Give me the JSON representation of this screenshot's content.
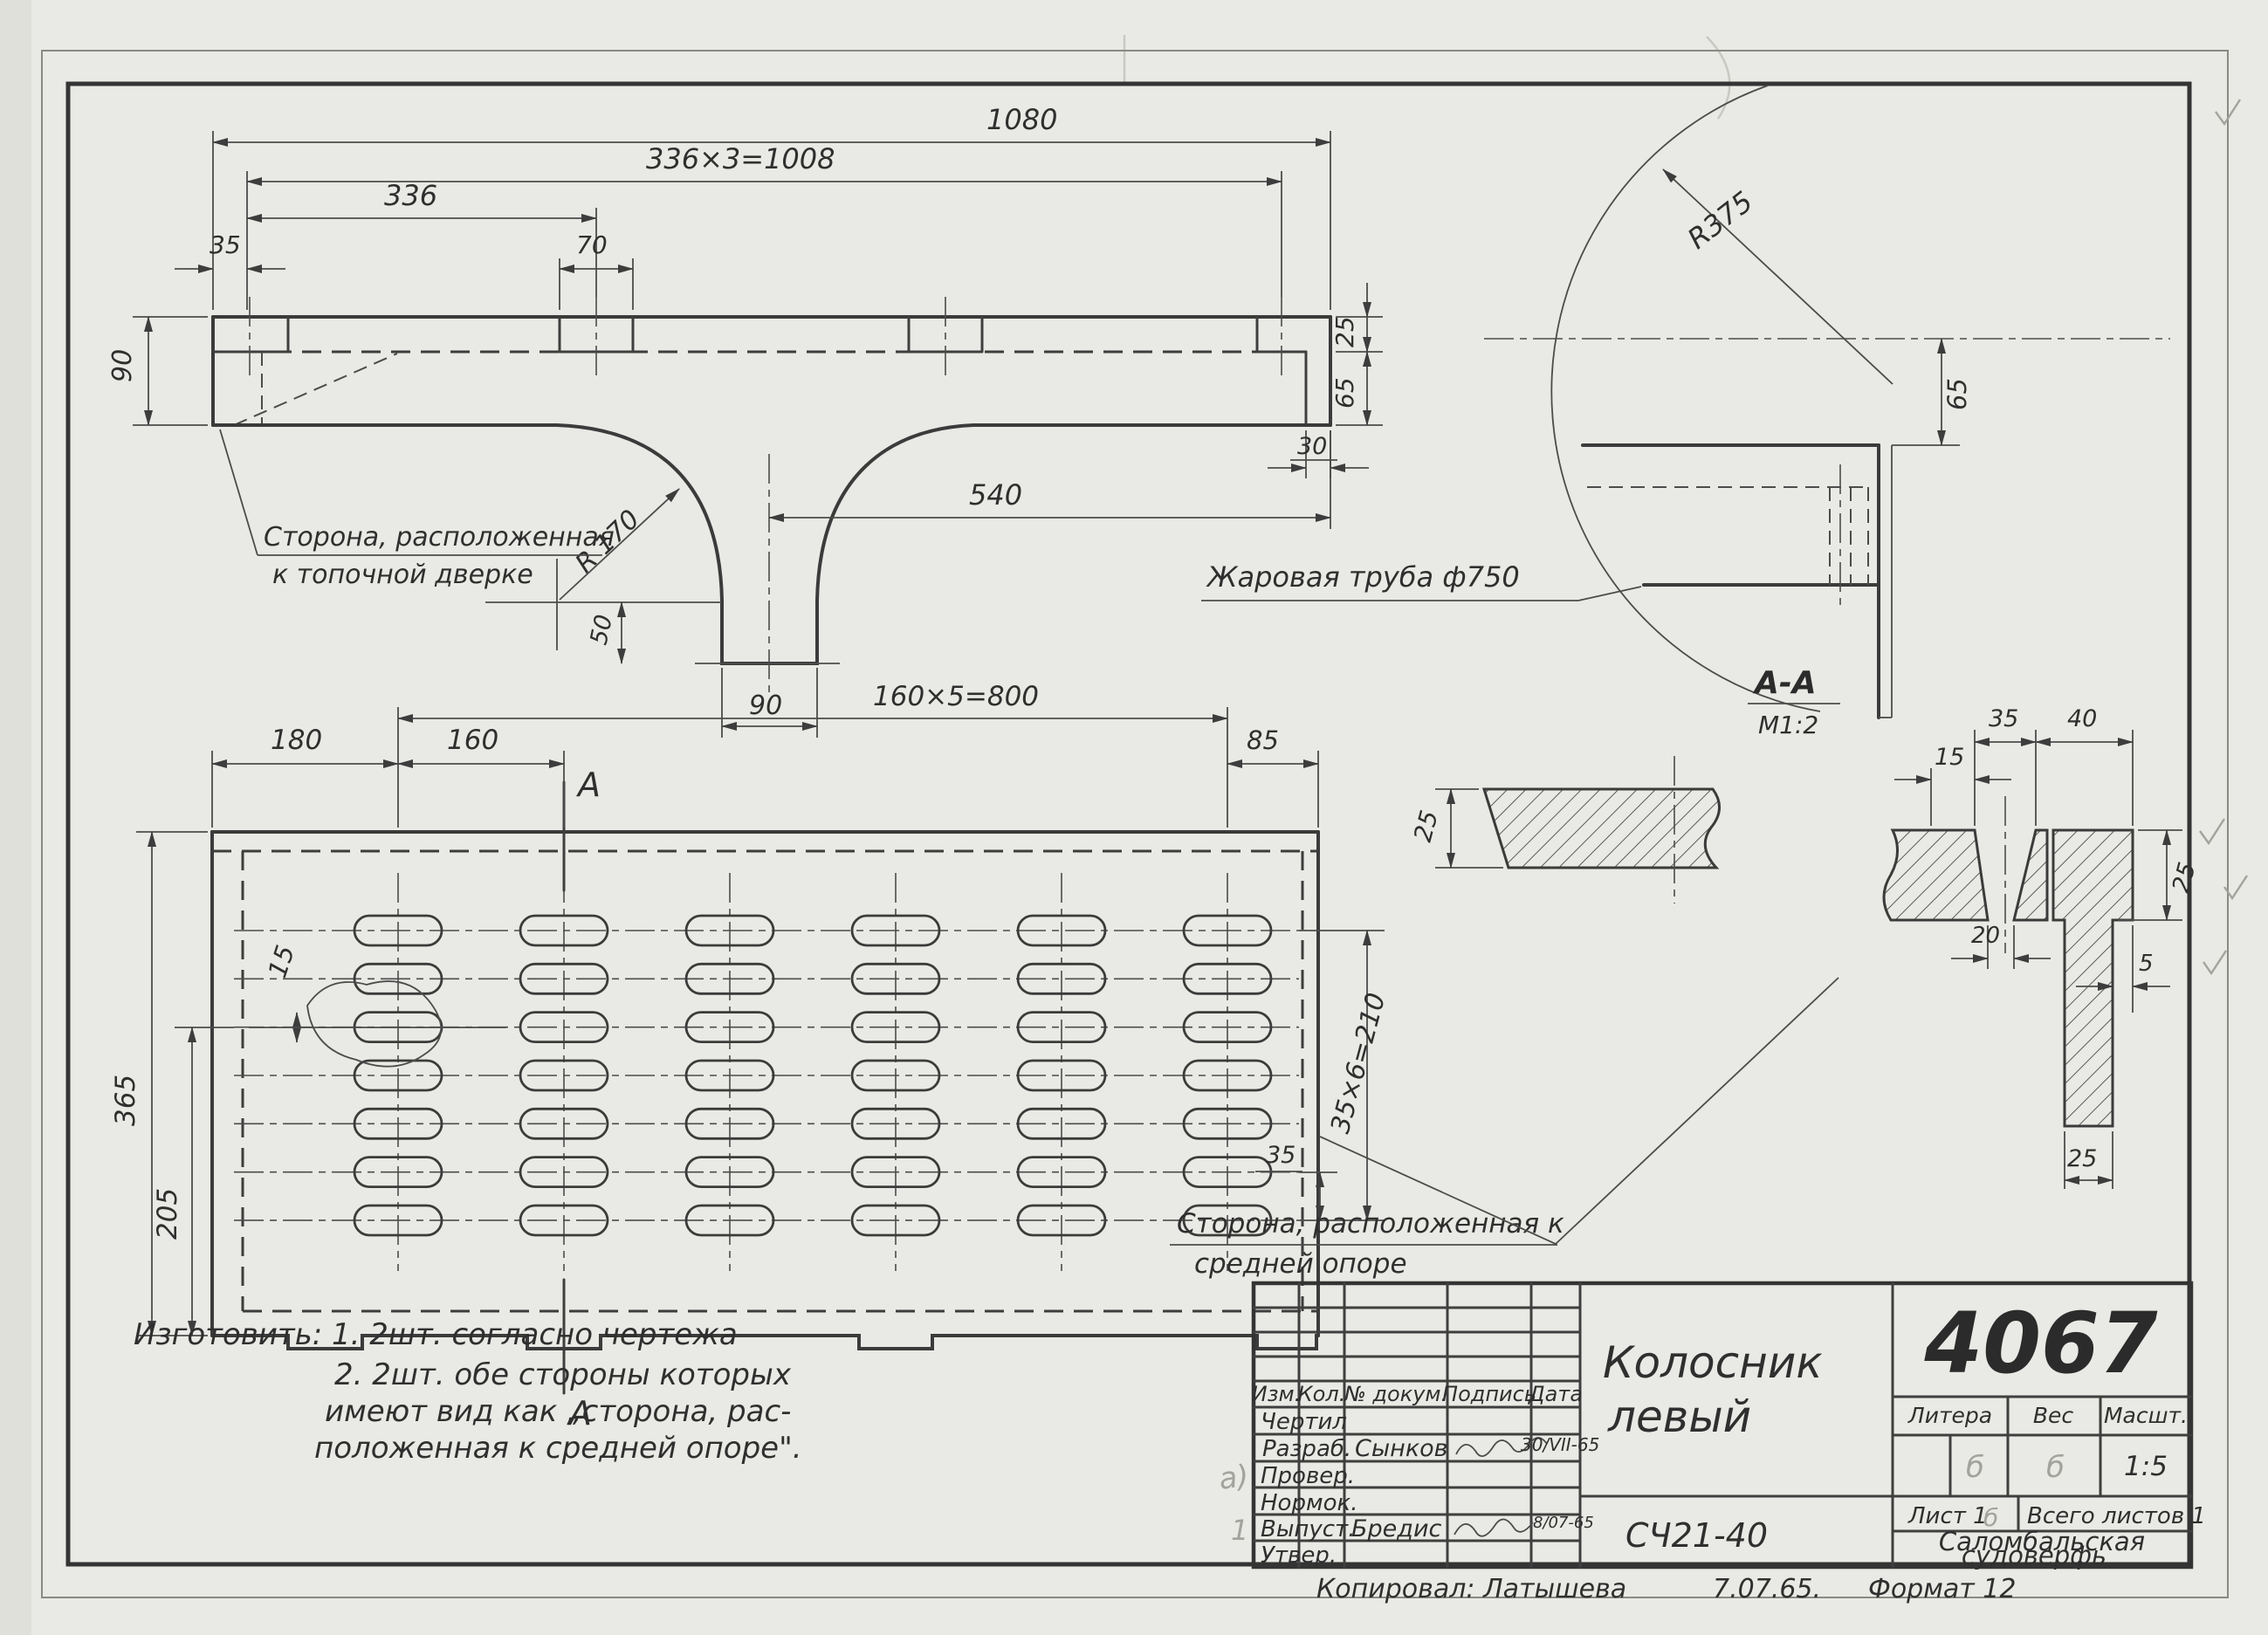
{
  "side_view": {
    "dim_1080": "1080",
    "dim_1008": "336×3=1008",
    "dim_336": "336",
    "dim_35": "35",
    "dim_70": "70",
    "dim_90_left": "90",
    "dim_25": "25",
    "dim_65": "65",
    "dim_30": "30",
    "dim_540": "540",
    "dim_50": "50",
    "dim_90_leg": "90",
    "radius_fillet": "R 170",
    "label_door_side_1": "Сторона, расположенная",
    "label_door_side_2": "к топочной дверке"
  },
  "detail_view": {
    "radius": "R375",
    "dim_65": "65",
    "flue_label": "Жаровая труба ф750"
  },
  "plan_view": {
    "dim_180": "180",
    "dim_160": "160",
    "dim_800": "160×5=800",
    "dim_85": "85",
    "dim_365": "365",
    "dim_205": "205",
    "dim_15": "15",
    "dim_210": "35×6=210",
    "dim_35": "35",
    "section_mark_top": "А",
    "section_mark_bottom": "А",
    "label_support_side_1": "Сторона, расположенная к",
    "label_support_side_2": "средней опоре",
    "slot_columns": 6,
    "slot_rows": 7
  },
  "section_view": {
    "label": "А-А",
    "scale": "М1:2",
    "dim_25_bar": "25",
    "dim_15": "15",
    "dim_35": "35",
    "dim_40": "40",
    "dim_20": "20",
    "dim_25_flange": "25",
    "dim_5": "5",
    "dim_25_web": "25"
  },
  "notes": {
    "line1": "Изготовить:  1. 2шт. согласно чертежа",
    "line2": "2. 2шт. обе стороны которых",
    "line3": "имеют вид как „сторона, рас-",
    "line4": "положенная к средней опоре\"."
  },
  "title_block": {
    "header_cols": [
      "Изм.",
      "Кол.",
      "№ докум.",
      "Подпись",
      "Дата"
    ],
    "row_labels": [
      "Чертил",
      "Разраб.",
      "Провер.",
      "Нормок.",
      "Выпуст.",
      "Утвер."
    ],
    "developer_name": "Сынков",
    "developer_date": "30/VII-65",
    "issuer_name": "Бредис",
    "issuer_date": "8/07-65",
    "pencil_mark_a": "а)",
    "pencil_mark_rev": "1",
    "pencil_litera": "б",
    "pencil_weight": "б",
    "pencil_sheet": "б",
    "drawing_number": "4067",
    "litera_label": "Литера",
    "weight_label": "Вес",
    "scale_label": "Масшт.",
    "scale_value": "1:5",
    "sheet_info": "Лист 1",
    "sheets_total": "Всего листов 1",
    "org_line1": "Саломбальская",
    "org_line2": "судоверфь",
    "part_title_1": "Колосник",
    "part_title_2": "левый",
    "material": "СЧ21-40",
    "copied_line": "Копировал: Латышева",
    "copy_date": "7.07.65.",
    "format_note": "Формат 12"
  }
}
